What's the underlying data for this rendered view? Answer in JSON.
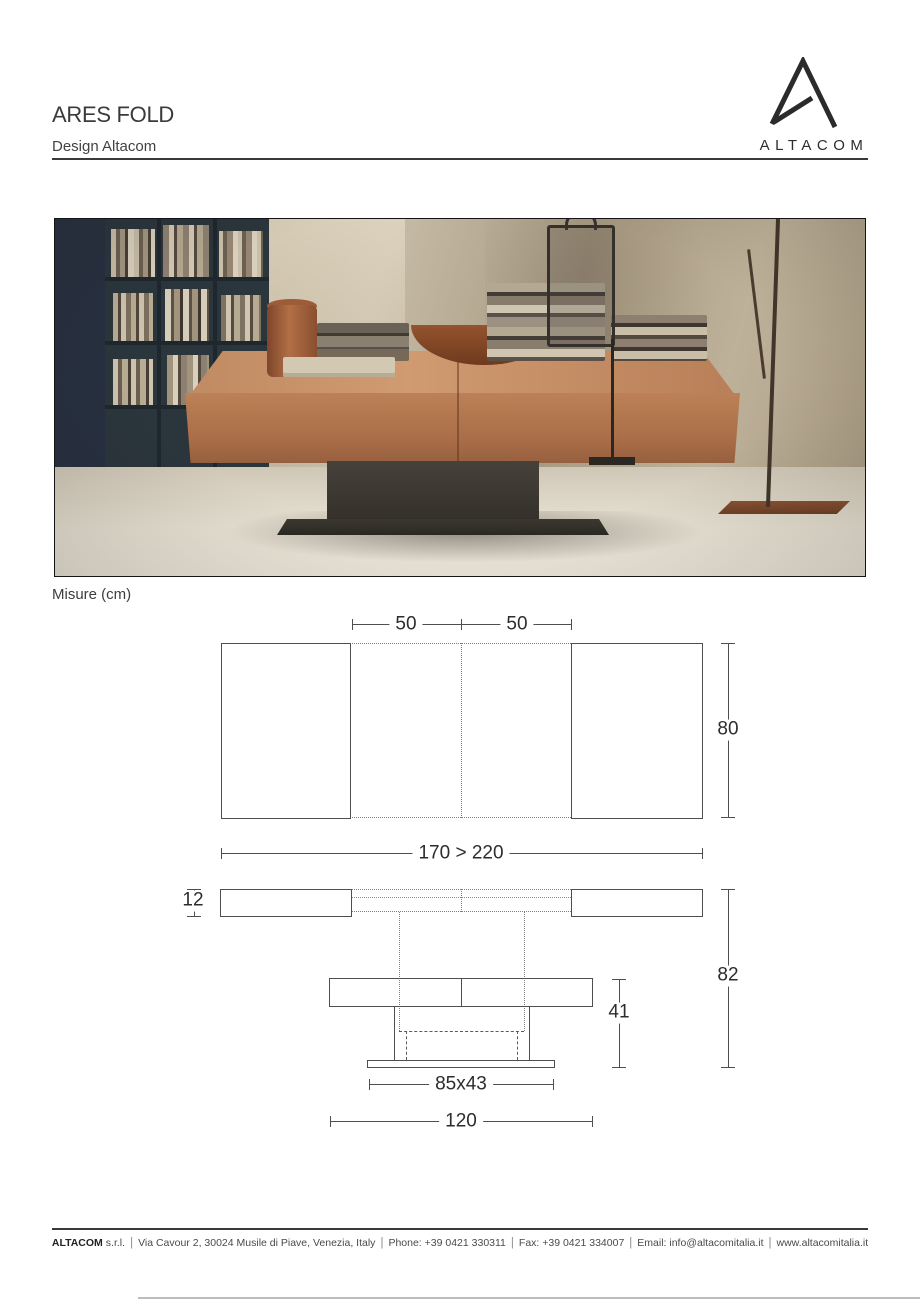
{
  "header": {
    "title": "ARES FOLD",
    "subtitle": "Design Altacom"
  },
  "brand": {
    "wordmark": "ALTACOM",
    "logo_icon": "altacom-a-mark",
    "logo_color": "#2b2b2b"
  },
  "measures": {
    "label": "Misure (cm)",
    "unit": "cm"
  },
  "drawing": {
    "line_color": "#4f4f4f",
    "top_view": {
      "leaf_left": "50",
      "leaf_right": "50",
      "depth": "80",
      "length_range": "170 > 220"
    },
    "front_view": {
      "top_thickness": "12",
      "lowered_height": "41",
      "raised_height": "82",
      "base_size": "85x43",
      "lowered_length": "120"
    }
  },
  "footer": {
    "company": "ALTACOM",
    "company_type": "s.r.l.",
    "separator": "|",
    "address": "Via Cavour 2, 30024 Musile di Piave, Venezia, Italy",
    "phone": "Phone: +39 0421 330311",
    "fax": "Fax: +39 0421 334007",
    "email": "Email: info@altacomitalia.it",
    "website": "www.altacomitalia.it"
  }
}
